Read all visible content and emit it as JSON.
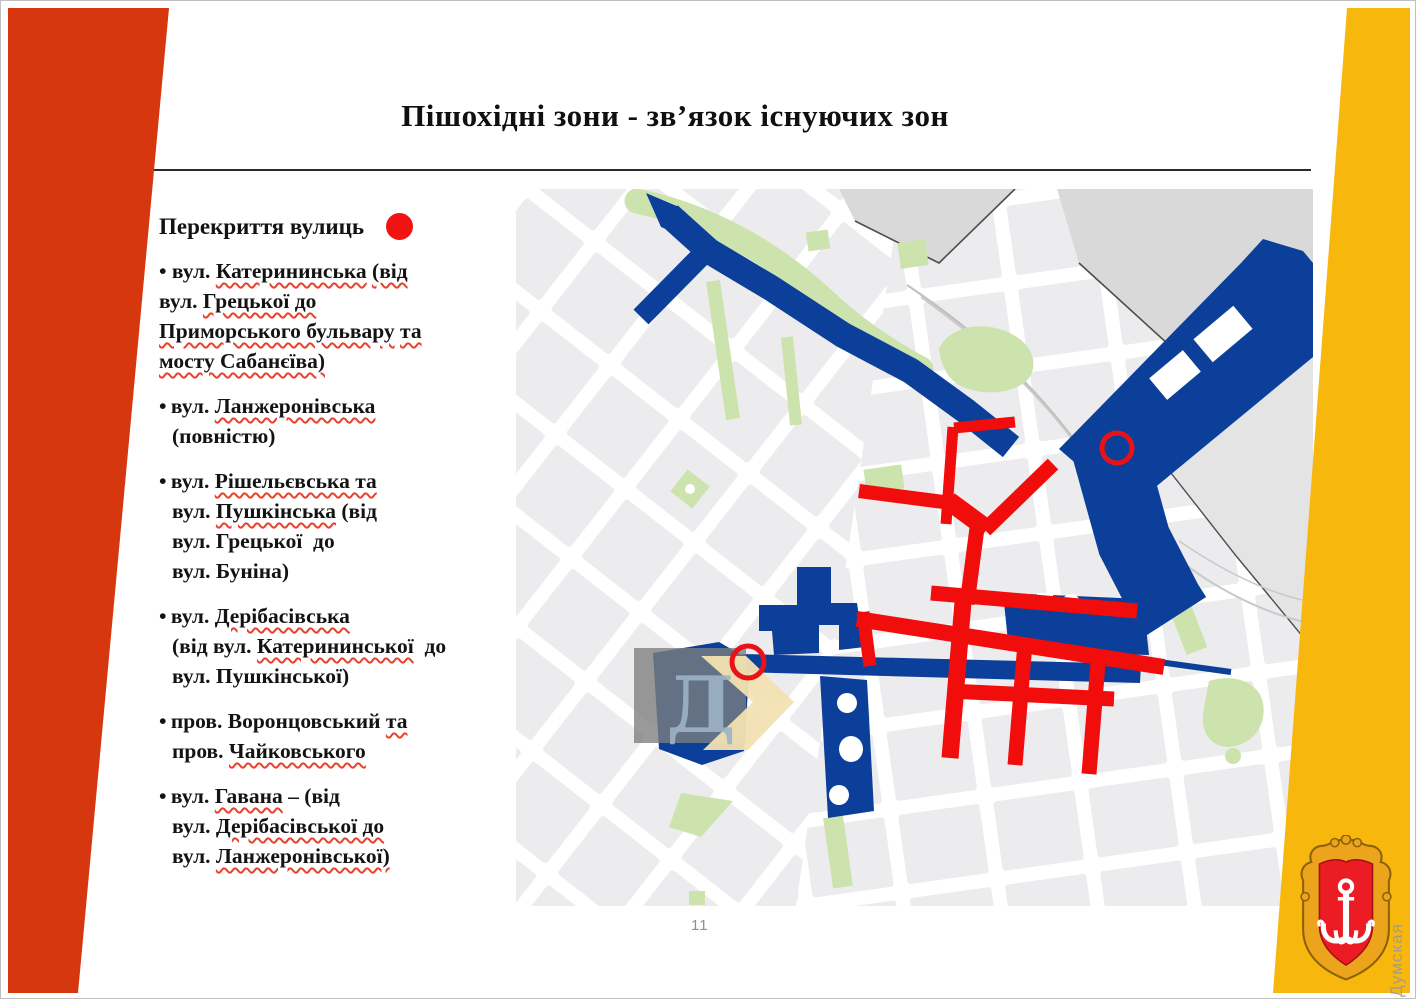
{
  "slide": {
    "title": "Пішохідні зони - зв’язок існуючих зон",
    "page_number": "11"
  },
  "legend": {
    "heading": "Перекриття вулиць",
    "items": [
      {
        "hang": false,
        "segments": [
          {
            "t": "• вул. "
          },
          {
            "t": "Катерининська",
            "w": true
          },
          {
            "t": " "
          },
          {
            "t": "(від",
            "w": true
          },
          {
            "br": true
          },
          {
            "t": "вул. "
          },
          {
            "t": "Грецької до",
            "w": true
          },
          {
            "br": true
          },
          {
            "t": "Приморського бульвару",
            "w": true
          },
          {
            "t": " "
          },
          {
            "t": "та",
            "w": true
          },
          {
            "br": true
          },
          {
            "t": "мосту Сабанєїва)",
            "w": true
          }
        ]
      },
      {
        "hang": true,
        "segments": [
          {
            "t": "• вул. "
          },
          {
            "t": "Ланжеронівська",
            "w": true
          },
          {
            "br": true
          },
          {
            "t": "(повністю)"
          }
        ]
      },
      {
        "hang": true,
        "segments": [
          {
            "t": "• вул. "
          },
          {
            "t": "Рішельєвська та",
            "w": true
          },
          {
            "br": true
          },
          {
            "t": "вул. "
          },
          {
            "t": "Пушкінська",
            "w": true
          },
          {
            "t": " (від"
          },
          {
            "br": true
          },
          {
            "t": "вул. Грецької  до"
          },
          {
            "br": true
          },
          {
            "t": "вул. Буніна)"
          }
        ]
      },
      {
        "hang": true,
        "segments": [
          {
            "t": "• вул. "
          },
          {
            "t": "Дерібасівська",
            "w": true
          },
          {
            "br": true
          },
          {
            "t": "(від вул. "
          },
          {
            "t": "Катерининської",
            "w": true
          },
          {
            "t": "  до"
          },
          {
            "br": true
          },
          {
            "t": "вул. Пушкінської)"
          }
        ]
      },
      {
        "hang": true,
        "segments": [
          {
            "t": "• пров. Воронцовський "
          },
          {
            "t": "та",
            "w": true
          },
          {
            "br": true
          },
          {
            "t": "пров. "
          },
          {
            "t": "Чайковського",
            "w": true
          }
        ]
      },
      {
        "hang": true,
        "segments": [
          {
            "t": "• вул. "
          },
          {
            "t": "Гавана",
            "w": true
          },
          {
            "t": " – (від"
          },
          {
            "br": true
          },
          {
            "t": "вул. "
          },
          {
            "t": "Дерібасівської до",
            "w": true
          },
          {
            "br": true
          },
          {
            "t": "вул. "
          },
          {
            "t": "Ланжеронівської)",
            "w": true
          }
        ]
      }
    ]
  },
  "map": {
    "colors": {
      "pedestrian_zone": "#0c3f99",
      "street_closure": "#f20d0d",
      "closure_marker_ring": "#e81219",
      "park": "#cde3ad",
      "city_block": "#ececee",
      "port_area": "#d9d9da",
      "legend_dot": "#f21212"
    }
  },
  "stripes": {
    "left_color": "#d6370e",
    "right_color": "#f7b70c"
  },
  "watermarks": {
    "map_letter": "Д",
    "site_name": "Думская"
  }
}
